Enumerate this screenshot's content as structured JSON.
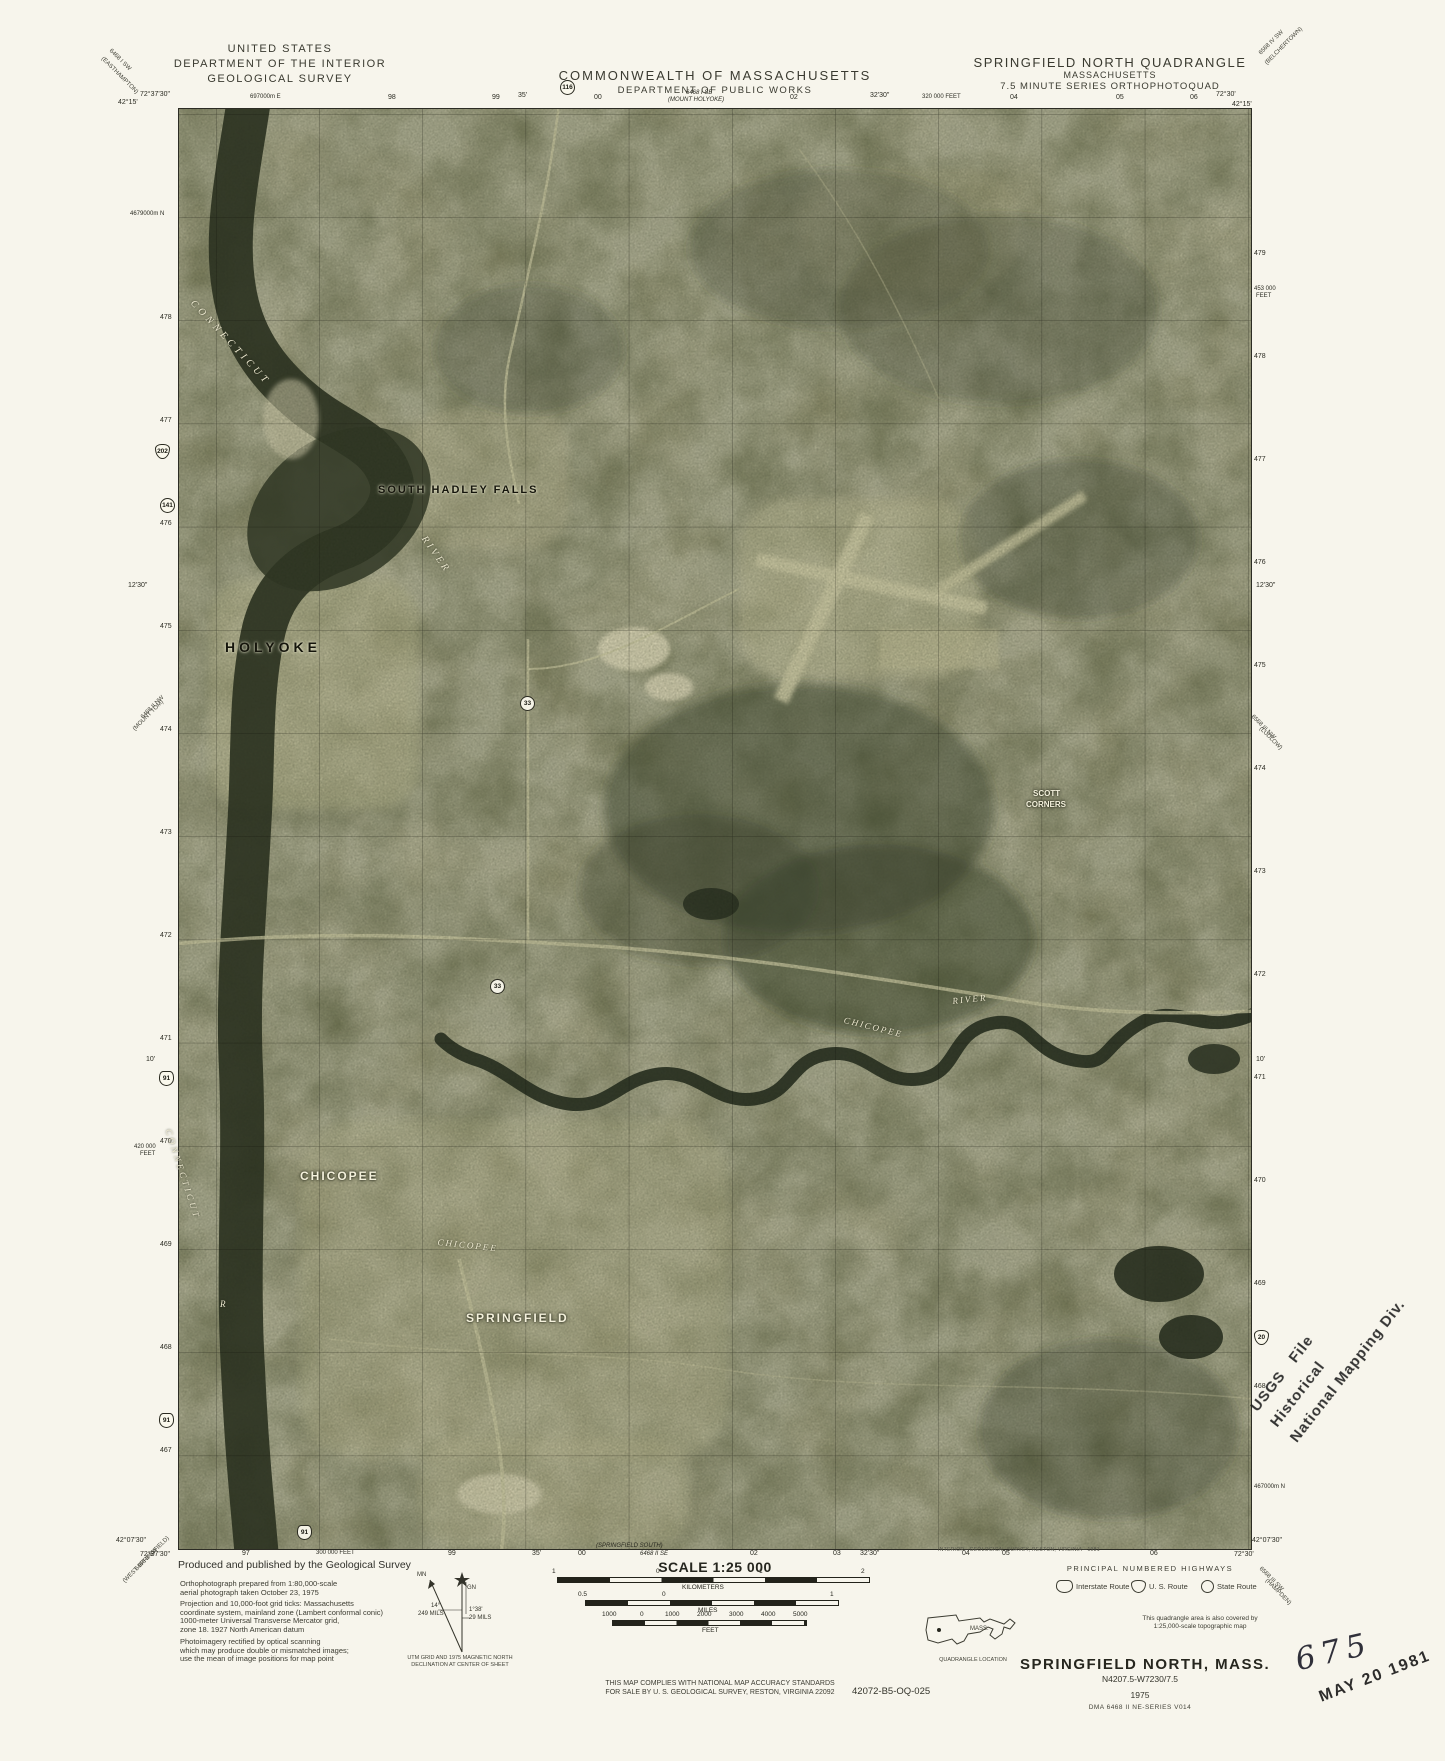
{
  "header": {
    "usgs": "UNITED STATES\nDEPARTMENT OF THE INTERIOR\nGEOLOGICAL SURVEY",
    "mass1": "COMMONWEALTH OF MASSACHUSETTS",
    "mass2": "DEPARTMENT OF PUBLIC WORKS",
    "quad1": "SPRINGFIELD NORTH QUADRANGLE",
    "quad2": "MASSACHUSETTS",
    "quad3": "7.5 MINUTE SERIES ORTHOPHOTOQUAD"
  },
  "palette": {
    "paper": "#f7f5ec",
    "photo_base": "#95926c",
    "photo_dark": "#262d1c",
    "photo_light": "#cdc9a0",
    "ink": "#2b2b22"
  },
  "footer": {
    "produced_title": "Produced and published by the Geological Survey",
    "note1": "Orthophotograph prepared from 1:80,000-scale\naerial photograph taken October 23, 1975",
    "note2": "Projection and 10,000-foot grid ticks: Massachusetts\ncoordinate system, mainland zone (Lambert conformal conic)\n1000-meter Universal Transverse Mercator grid,\nzone 18.   1927 North American datum",
    "note3": "Photoimagery rectified by optical scanning\nwhich may produce double or mismatched images;\nuse the mean of image positions for map point",
    "declination_caption": "UTM GRID AND 1975 MAGNETIC NORTH\nDECLINATION AT CENTER OF SHEET",
    "scale_title": "SCALE 1:25 000",
    "compliance": "THIS MAP COMPLIES WITH NATIONAL MAP ACCURACY STANDARDS\nFOR SALE BY U. S. GEOLOGICAL SURVEY, RESTON, VIRGINIA 22092",
    "catalog": "42072-B5-OQ-025",
    "credit": "INTERIOR—GEOLOGICAL SURVEY, RESTON, VIRGINIA—1981",
    "covered": "This quadrangle area is also covered by\n1:25,000-scale topographic map",
    "quad_location_caption": "QUADRANGLE LOCATION",
    "state_abbrev": "MASS.",
    "highways": {
      "title": "PRINCIPAL NUMBERED HIGHWAYS",
      "items": [
        {
          "shape": "interstate",
          "label": "Interstate Route",
          "x": 1056,
          "y": 1580
        },
        {
          "shape": "us",
          "label": "U. S. Route",
          "x": 1131,
          "y": 1580
        },
        {
          "shape": "state",
          "label": "State Route",
          "x": 1201,
          "y": 1580
        }
      ]
    },
    "title_block": {
      "name": "SPRINGFIELD NORTH, MASS.",
      "code": "N4207.5-W7230/7.5",
      "year": "1975",
      "dma": "DMA 6468 II NE-SERIES V014"
    }
  },
  "stamps": {
    "hist_line1": "USGS   File",
    "hist_line2": "Historical",
    "hist_line3": "National Mapping Div.",
    "accession": "675",
    "date": "MAY 20 1981"
  },
  "declination": {
    "mn": "MN",
    "gn": "GN",
    "angle1": "14°",
    "mils1": "249 MILS",
    "angle2": "1°38'",
    "mils2": "29 MILS"
  },
  "map": {
    "abs": [
      {
        "t": "72°37'30\"",
        "x": 140,
        "y": 91,
        "c": "tick"
      },
      {
        "t": "42°15'",
        "x": 118,
        "y": 99,
        "c": "tick"
      },
      {
        "t": "697000m E",
        "x": 250,
        "y": 94,
        "c": "sm"
      },
      {
        "t": "98",
        "x": 388,
        "y": 94,
        "c": "tick"
      },
      {
        "t": "99",
        "x": 492,
        "y": 94,
        "c": "tick"
      },
      {
        "t": "35'",
        "x": 518,
        "y": 92,
        "c": "tick"
      },
      {
        "t": "00",
        "x": 594,
        "y": 94,
        "c": "tick"
      },
      {
        "t": "6468 I SE",
        "x": 686,
        "y": 90,
        "c": "it"
      },
      {
        "t": "(MOUNT HOLYOKE)",
        "x": 668,
        "y": 97,
        "c": "it"
      },
      {
        "t": "02",
        "x": 790,
        "y": 94,
        "c": "tick"
      },
      {
        "t": "32'30\"",
        "x": 870,
        "y": 92,
        "c": "tick"
      },
      {
        "t": "320 000 FEET",
        "x": 922,
        "y": 94,
        "c": "sm"
      },
      {
        "t": "04",
        "x": 1010,
        "y": 94,
        "c": "tick"
      },
      {
        "t": "05",
        "x": 1116,
        "y": 94,
        "c": "tick"
      },
      {
        "t": "06",
        "x": 1190,
        "y": 94,
        "c": "tick"
      },
      {
        "t": "72°30'",
        "x": 1216,
        "y": 91,
        "c": "tick"
      },
      {
        "t": "42°15'",
        "x": 1232,
        "y": 101,
        "c": "tick"
      },
      {
        "t": "42°07'30\"",
        "x": 116,
        "y": 1537,
        "c": "tick"
      },
      {
        "t": "72°37'30\"",
        "x": 140,
        "y": 1551,
        "c": "tick"
      },
      {
        "t": "97",
        "x": 242,
        "y": 1550,
        "c": "tick"
      },
      {
        "t": "300 000 FEET",
        "x": 316,
        "y": 1550,
        "c": "sm"
      },
      {
        "t": "99",
        "x": 448,
        "y": 1550,
        "c": "tick"
      },
      {
        "t": "35'",
        "x": 532,
        "y": 1550,
        "c": "tick"
      },
      {
        "t": "00",
        "x": 578,
        "y": 1550,
        "c": "tick"
      },
      {
        "t": "(SPRINGFIELD SOUTH)",
        "x": 596,
        "y": 1543,
        "c": "it"
      },
      {
        "t": "6468 II SE",
        "x": 640,
        "y": 1551,
        "c": "it"
      },
      {
        "t": "02",
        "x": 750,
        "y": 1550,
        "c": "tick"
      },
      {
        "t": "03",
        "x": 833,
        "y": 1550,
        "c": "tick"
      },
      {
        "t": "32'30\"",
        "x": 860,
        "y": 1550,
        "c": "tick"
      },
      {
        "t": "04",
        "x": 962,
        "y": 1550,
        "c": "tick"
      },
      {
        "t": "05",
        "x": 1002,
        "y": 1550,
        "c": "tick"
      },
      {
        "t": "06",
        "x": 1150,
        "y": 1550,
        "c": "tick"
      },
      {
        "t": "72°30'",
        "x": 1234,
        "y": 1551,
        "c": "tick"
      },
      {
        "t": "42°07'30\"",
        "x": 1252,
        "y": 1537,
        "c": "tick"
      },
      {
        "t": "4679000m N",
        "x": 130,
        "y": 211,
        "c": "sm"
      },
      {
        "t": "478",
        "x": 160,
        "y": 314,
        "c": "tick"
      },
      {
        "t": "477",
        "x": 160,
        "y": 417,
        "c": "tick"
      },
      {
        "t": "476",
        "x": 160,
        "y": 520,
        "c": "tick"
      },
      {
        "t": "475",
        "x": 160,
        "y": 623,
        "c": "tick"
      },
      {
        "t": "474",
        "x": 160,
        "y": 726,
        "c": "tick"
      },
      {
        "t": "473",
        "x": 160,
        "y": 829,
        "c": "tick"
      },
      {
        "t": "472",
        "x": 160,
        "y": 932,
        "c": "tick"
      },
      {
        "t": "471",
        "x": 160,
        "y": 1035,
        "c": "tick"
      },
      {
        "t": "470",
        "x": 160,
        "y": 1138,
        "c": "tick"
      },
      {
        "t": "469",
        "x": 160,
        "y": 1241,
        "c": "tick"
      },
      {
        "t": "468",
        "x": 160,
        "y": 1344,
        "c": "tick"
      },
      {
        "t": "467",
        "x": 160,
        "y": 1447,
        "c": "tick"
      },
      {
        "t": "12'30\"",
        "x": 128,
        "y": 582,
        "c": "tick"
      },
      {
        "t": "10'",
        "x": 146,
        "y": 1056,
        "c": "tick"
      },
      {
        "t": "420 000",
        "x": 134,
        "y": 1144,
        "c": "sm"
      },
      {
        "t": "FEET",
        "x": 140,
        "y": 1151,
        "c": "sm"
      },
      {
        "t": "479",
        "x": 1254,
        "y": 250,
        "c": "tick"
      },
      {
        "t": "453 000",
        "x": 1254,
        "y": 286,
        "c": "sm"
      },
      {
        "t": "FEET",
        "x": 1256,
        "y": 293,
        "c": "sm"
      },
      {
        "t": "478",
        "x": 1254,
        "y": 353,
        "c": "tick"
      },
      {
        "t": "477",
        "x": 1254,
        "y": 456,
        "c": "tick"
      },
      {
        "t": "476",
        "x": 1254,
        "y": 559,
        "c": "tick"
      },
      {
        "t": "475",
        "x": 1254,
        "y": 662,
        "c": "tick"
      },
      {
        "t": "474",
        "x": 1254,
        "y": 765,
        "c": "tick"
      },
      {
        "t": "473",
        "x": 1254,
        "y": 868,
        "c": "tick"
      },
      {
        "t": "472",
        "x": 1254,
        "y": 971,
        "c": "tick"
      },
      {
        "t": "471",
        "x": 1254,
        "y": 1074,
        "c": "tick"
      },
      {
        "t": "470",
        "x": 1254,
        "y": 1177,
        "c": "tick"
      },
      {
        "t": "469",
        "x": 1254,
        "y": 1280,
        "c": "tick"
      },
      {
        "t": "468",
        "x": 1254,
        "y": 1383,
        "c": "tick"
      },
      {
        "t": "467000m N",
        "x": 1254,
        "y": 1484,
        "c": "sm"
      },
      {
        "t": "12'30\"",
        "x": 1256,
        "y": 582,
        "c": "tick"
      },
      {
        "t": "10'",
        "x": 1256,
        "y": 1056,
        "c": "tick"
      },
      {
        "t": "6468 I SW",
        "x": 112,
        "y": 48,
        "c": "diag",
        "r": 45
      },
      {
        "t": "(EASTHAMPTON)",
        "x": 104,
        "y": 56,
        "c": "diag",
        "r": 45
      },
      {
        "t": "6568 IV SW",
        "x": 1258,
        "y": 52,
        "c": "diag",
        "r": -45
      },
      {
        "t": "(BELCHERTOWN)",
        "x": 1264,
        "y": 62,
        "c": "diag",
        "r": -45
      },
      {
        "t": "6468 II NW",
        "x": 140,
        "y": 716,
        "c": "diag",
        "r": -45
      },
      {
        "t": "(MOUNT TOM)",
        "x": 132,
        "y": 728,
        "c": "diag",
        "r": -45
      },
      {
        "t": "6568 III NW",
        "x": 1254,
        "y": 714,
        "c": "diag",
        "r": 45
      },
      {
        "t": "(LUDLOW)",
        "x": 1262,
        "y": 726,
        "c": "diag",
        "r": 45
      },
      {
        "t": "6468 II SW",
        "x": 134,
        "y": 1568,
        "c": "diag",
        "r": -45
      },
      {
        "t": "(WEST SPRINGFIELD)",
        "x": 122,
        "y": 1580,
        "c": "diag",
        "r": -45
      },
      {
        "t": "6568 III SW",
        "x": 1262,
        "y": 1566,
        "c": "diag",
        "r": 45
      },
      {
        "t": "(HAMPDEN)",
        "x": 1268,
        "y": 1578,
        "c": "diag",
        "r": 45
      },
      {
        "t": "SOUTH HADLEY FALLS",
        "x": 378,
        "y": 484,
        "c": "place",
        "fs": 11,
        "ls": 2
      },
      {
        "t": "HOLYOKE",
        "x": 225,
        "y": 640,
        "c": "place",
        "fs": 14,
        "ls": 4
      },
      {
        "t": "SCOTT",
        "x": 1033,
        "y": 790,
        "c": "place-w",
        "fs": 8
      },
      {
        "t": "CORNERS",
        "x": 1026,
        "y": 801,
        "c": "place-w",
        "fs": 8
      },
      {
        "t": "CHICOPEE",
        "x": 300,
        "y": 1170,
        "c": "place-w",
        "fs": 12,
        "ls": 2
      },
      {
        "t": "SPRINGFIELD",
        "x": 466,
        "y": 1312,
        "c": "place-w",
        "fs": 12,
        "ls": 2
      },
      {
        "t": "CONNECTICUT",
        "x": 196,
        "y": 298,
        "c": "water",
        "fs": 10,
        "ls": 4,
        "r": 47
      },
      {
        "t": "RIVER",
        "x": 428,
        "y": 534,
        "c": "water",
        "fs": 10,
        "ls": 3,
        "r": 55
      },
      {
        "t": "CONNECTICUT",
        "x": 172,
        "y": 1128,
        "c": "water",
        "fs": 9,
        "ls": 3,
        "r": 72
      },
      {
        "t": "R",
        "x": 220,
        "y": 1300,
        "c": "water",
        "fs": 9
      },
      {
        "t": "CHICOPEE",
        "x": 438,
        "y": 1238,
        "c": "water",
        "fs": 9,
        "ls": 2,
        "r": 6
      },
      {
        "t": "RIVER",
        "x": 952,
        "y": 997,
        "c": "water",
        "fs": 9,
        "ls": 2,
        "r": -6
      },
      {
        "t": "CHICOPEE",
        "x": 845,
        "y": 1016,
        "c": "water",
        "fs": 9,
        "ls": 2,
        "r": 14
      },
      {
        "t": "1",
        "x": 552,
        "y": 1568,
        "c": "bt"
      },
      {
        "t": "0",
        "x": 656,
        "y": 1568,
        "c": "bt"
      },
      {
        "t": "1",
        "x": 759,
        "y": 1568,
        "c": "bt"
      },
      {
        "t": "2",
        "x": 861,
        "y": 1568,
        "c": "bt"
      },
      {
        "t": "KILOMETERS",
        "x": 682,
        "y": 1584,
        "c": "bt"
      },
      {
        "t": "0.5",
        "x": 578,
        "y": 1591,
        "c": "bt"
      },
      {
        "t": "0",
        "x": 662,
        "y": 1591,
        "c": "bt"
      },
      {
        "t": "1",
        "x": 830,
        "y": 1591,
        "c": "bt"
      },
      {
        "t": "MILES",
        "x": 698,
        "y": 1607,
        "c": "bt"
      },
      {
        "t": "1000",
        "x": 602,
        "y": 1611,
        "c": "bt"
      },
      {
        "t": "0",
        "x": 640,
        "y": 1611,
        "c": "bt"
      },
      {
        "t": "1000",
        "x": 665,
        "y": 1611,
        "c": "bt"
      },
      {
        "t": "2000",
        "x": 697,
        "y": 1611,
        "c": "bt"
      },
      {
        "t": "3000",
        "x": 729,
        "y": 1611,
        "c": "bt"
      },
      {
        "t": "4000",
        "x": 761,
        "y": 1611,
        "c": "bt"
      },
      {
        "t": "5000",
        "x": 793,
        "y": 1611,
        "c": "bt"
      },
      {
        "t": "FEET",
        "x": 702,
        "y": 1627,
        "c": "bt"
      },
      {
        "t": "MN",
        "x": 417,
        "y": 1572,
        "c": "dec"
      },
      {
        "t": "GN",
        "x": 467,
        "y": 1585,
        "c": "dec"
      },
      {
        "t": "14°",
        "x": 431,
        "y": 1603,
        "c": "dec"
      },
      {
        "t": "249 MILS",
        "x": 418,
        "y": 1611,
        "c": "dec"
      },
      {
        "t": "1°38'",
        "x": 469,
        "y": 1607,
        "c": "dec"
      },
      {
        "t": "29 MILS",
        "x": 469,
        "y": 1615,
        "c": "dec"
      }
    ],
    "shields": [
      {
        "n": "116",
        "x": 560,
        "y": 80,
        "type": "state"
      },
      {
        "n": "202",
        "x": 155,
        "y": 444,
        "type": "us"
      },
      {
        "n": "141",
        "x": 160,
        "y": 498,
        "type": "state"
      },
      {
        "n": "33",
        "x": 520,
        "y": 696,
        "type": "state"
      },
      {
        "n": "33",
        "x": 490,
        "y": 979,
        "type": "state"
      },
      {
        "n": "91",
        "x": 159,
        "y": 1071,
        "type": "interstate"
      },
      {
        "n": "91",
        "x": 159,
        "y": 1413,
        "type": "interstate"
      },
      {
        "n": "91",
        "x": 297,
        "y": 1525,
        "type": "interstate"
      },
      {
        "n": "20",
        "x": 1254,
        "y": 1330,
        "type": "us"
      }
    ]
  }
}
